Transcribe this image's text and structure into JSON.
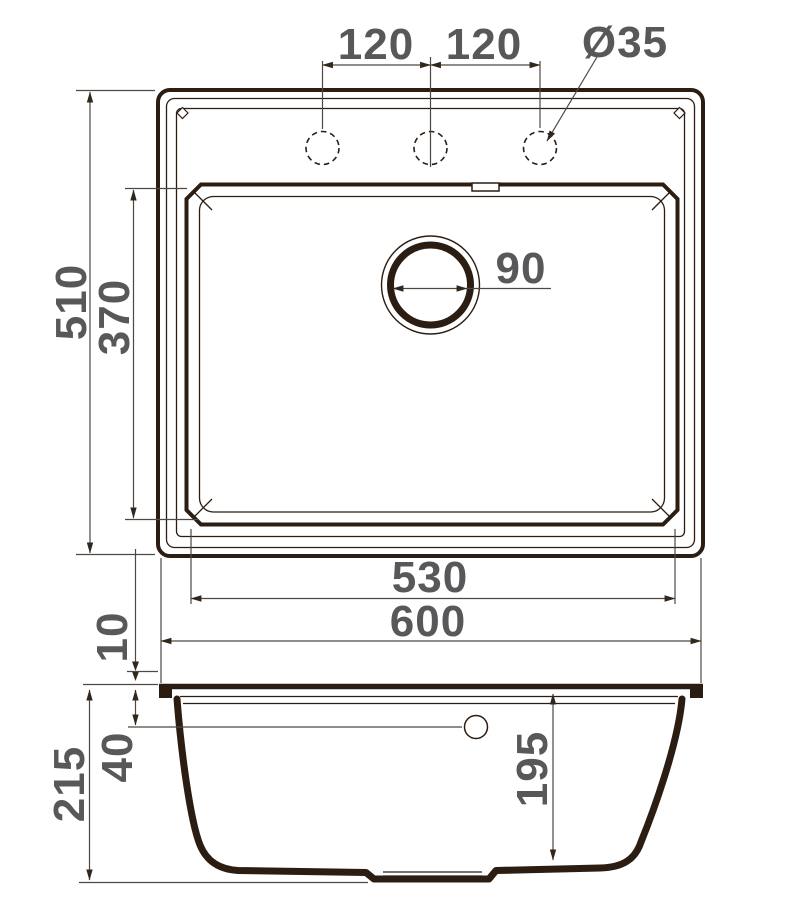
{
  "title": "Kitchen sink dimensional drawing, top view and sectional side view",
  "colors": {
    "background": "#ffffff",
    "line": "#2b1d12",
    "dim_line": "#4e4840",
    "text": "#58585b"
  },
  "top_view": {
    "faucet_spacing_left": "120",
    "faucet_spacing_right": "120",
    "faucet_hole_diameter": "Ø35",
    "drain_diameter": "90",
    "overall_depth": "510",
    "bowl_depth": "370",
    "bowl_width": "530",
    "overall_width": "600"
  },
  "side_view": {
    "rim_height": "10",
    "overflow_depth": "40",
    "overall_height": "215",
    "bowl_inner_depth": "195"
  }
}
